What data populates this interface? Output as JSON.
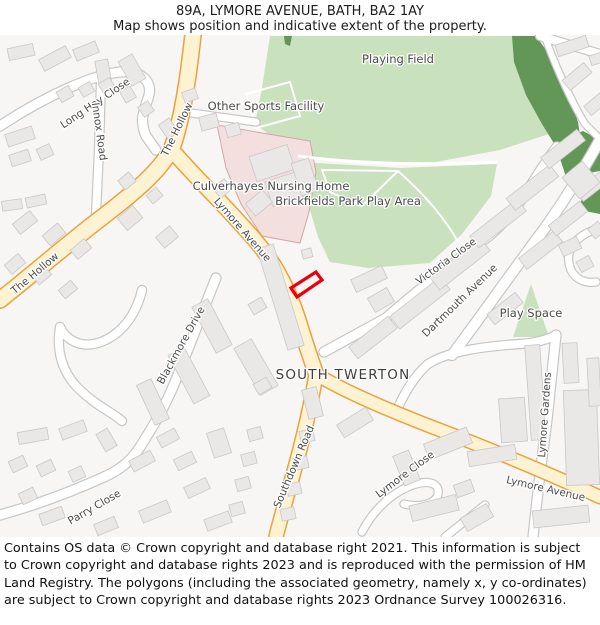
{
  "header": {
    "title": "89A, LYMORE AVENUE, BATH, BA2 1AY",
    "subtitle": "Map shows position and indicative extent of the property."
  },
  "footer": {
    "text": "Contains OS data © Crown copyright and database right 2021. This information is subject to Crown copyright and database rights 2023 and is reproduced with the permission of HM Land Registry. The polygons (including the associated geometry, namely x, y co-ordinates) are subject to Crown copyright and database rights 2023 Ordnance Survey 100026316."
  },
  "map": {
    "background": "#f7f6f4",
    "palette": {
      "lightGreen": "#c9e1bc",
      "darkGreen": "#629757",
      "pinkFill": "#f4dfdf",
      "pinkStroke": "#d3a6a4",
      "buildingFill": "#e9e8e6",
      "buildingStroke": "#c9c8c6",
      "roadFill": "#ffffff",
      "roadCasing": "#c6c6c6",
      "primaryFill": "#fdf3d3",
      "primaryCasing": "#eca13b"
    },
    "areas": [
      {
        "name": "playing-field-green",
        "points": "270,36 512,36 530,64 545,100 552,133 500,150 430,163 365,161 298,156 255,124 262,88",
        "fill": "lightGreen"
      },
      {
        "name": "brickfields-green",
        "points": "300,162 400,168 497,164 491,196 462,234 430,263 368,268 330,262 318,237 306,196",
        "fill": "lightGreen"
      },
      {
        "name": "tree-strip",
        "points": "512,36 536,36 556,64 569,92 578,122 580,135 558,150 542,124 526,95 514,62",
        "fill": "darkGreen"
      },
      {
        "name": "tree-wedge",
        "points": "555,143 583,131 600,140 600,171 566,177",
        "fill": "darkGreen"
      },
      {
        "name": "tree-patch",
        "points": "584,181 600,177 600,214 580,210",
        "fill": "darkGreen"
      },
      {
        "name": "tree-sliver",
        "points": "284,36 292,36 290,46 285,44",
        "fill": "darkGreen"
      },
      {
        "name": "nursing-home-grounds",
        "points": "217,125 262,133 310,141 316,172 309,212 300,243 262,236 241,204 226,168",
        "fill": "pinkFill",
        "stroke": "pinkStroke"
      },
      {
        "name": "play-space-green",
        "points": "531,284 549,337 513,337",
        "fill": "lightGreen"
      }
    ],
    "roads": [
      {
        "name": "long-hay-close-road",
        "kind": "minor",
        "width": 9,
        "d": "M 0,126 C 45,96 95,74 120,72 C 142,70 152,82 149,95 C 146,107 138,118 146,136 L 156,150"
      },
      {
        "name": "innox-road-road",
        "kind": "minor",
        "width": 8,
        "d": "M 101,80 L 99,150 L 96,214"
      },
      {
        "name": "sports-access-road",
        "kind": "minor",
        "width": 7,
        "d": "M 184,112 L 256,122"
      },
      {
        "name": "blackmore-drive-road",
        "kind": "minor",
        "width": 9,
        "d": "M 216,278 C 205,305 190,345 175,382 C 165,407 152,428 140,447"
      },
      {
        "name": "leftmid-road-a",
        "kind": "minor",
        "width": 8,
        "d": "M 142,290 C 136,316 120,336 98,343 C 80,348 66,340 60,327"
      },
      {
        "name": "leftmid-road-b",
        "kind": "minor",
        "width": 8,
        "d": "M 60,327 C 56,350 62,372 78,388 C 96,406 112,412 122,421"
      },
      {
        "name": "parry-close-road",
        "kind": "minor",
        "width": 9,
        "d": "M 140,447 C 132,460 120,470 104,477 C 75,490 40,504 0,515"
      },
      {
        "name": "victoria-close-road",
        "kind": "minor",
        "width": 9,
        "d": "M 324,352 L 386,318 C 420,288 455,262 490,235 C 505,222 518,205 528,190 C 537,176 546,161 557,147"
      },
      {
        "name": "dartmouth-avenue-road",
        "kind": "minor",
        "width": 10,
        "d": "M 452,355 C 480,318 512,272 545,228 C 565,200 582,172 600,140"
      },
      {
        "name": "cross-road-south",
        "kind": "minor",
        "width": 8,
        "d": "M 396,412 C 402,398 412,378 428,364 C 450,350 490,346 520,344 C 536,343 549,339 556,335"
      },
      {
        "name": "lymore-gardens-road",
        "kind": "minor",
        "width": 9,
        "d": "M 556,335 L 547,420 L 539,482 L 533,537"
      },
      {
        "name": "cul-de-sac-road",
        "kind": "minor",
        "width": 7,
        "d": "M 600,228 C 578,234 566,248 569,263 C 571,277 583,284 596,282"
      },
      {
        "name": "lymore-close-road",
        "kind": "minor",
        "width": 7,
        "d": "M 362,532 C 372,512 390,494 410,486 C 428,479 440,483 438,494 C 436,504 420,508 404,504"
      },
      {
        "name": "topright-road-a",
        "kind": "minor",
        "width": 8,
        "d": "M 540,36 L 600,54"
      },
      {
        "name": "topright-road-b",
        "kind": "minor",
        "width": 6,
        "d": "M 546,40 C 558,72 572,102 585,124 L 600,139"
      },
      {
        "name": "bottomright-corner-road",
        "kind": "minor",
        "width": 7,
        "d": "M 445,537 L 485,505"
      },
      {
        "name": "the-hollow-road",
        "kind": "primary",
        "width": 15,
        "d": "M 193,35 C 188,80 182,120 172,148 C 160,172 130,196 96,222 C 70,242 35,272 0,300"
      },
      {
        "name": "lymore-avenue-road",
        "kind": "primary",
        "width": 14,
        "d": "M 172,150 C 190,172 225,205 255,240 C 275,263 290,292 300,325 C 306,345 312,362 316,374"
      },
      {
        "name": "southdown-road-road",
        "kind": "primary",
        "width": 13,
        "d": "M 316,374 C 312,400 303,440 293,475 C 286,500 280,520 276,537"
      },
      {
        "name": "lymore-avenue-east-road",
        "kind": "primary",
        "width": 12,
        "d": "M 316,374 C 345,392 395,413 445,432 C 495,451 545,472 600,497"
      }
    ],
    "paths": [
      {
        "name": "sports-pitch-outline",
        "width": 2,
        "d": "M 246,94 L 290,82 L 300,116 L 256,128 Z"
      },
      {
        "name": "park-path-separator",
        "width": 3,
        "d": "M 298,156 C 350,163 420,166 497,162"
      },
      {
        "name": "park-path-loop",
        "width": 2,
        "d": "M 322,170 L 398,171 L 362,206 L 330,192 Z"
      },
      {
        "name": "park-path-southeast",
        "width": 2,
        "d": "M 398,171 C 425,195 445,218 458,242"
      }
    ],
    "buildings": [
      [
        8,
        46,
        26,
        12,
        -12
      ],
      [
        40,
        52,
        30,
        13,
        -28
      ],
      [
        74,
        45,
        24,
        12,
        -22
      ],
      [
        97,
        60,
        13,
        26,
        -10
      ],
      [
        124,
        56,
        16,
        28,
        -30
      ],
      [
        58,
        88,
        14,
        12,
        -30
      ],
      [
        80,
        84,
        13,
        11,
        -30
      ],
      [
        100,
        80,
        13,
        11,
        -30
      ],
      [
        122,
        88,
        12,
        13,
        -30
      ],
      [
        140,
        103,
        12,
        12,
        -35
      ],
      [
        6,
        130,
        28,
        13,
        -18
      ],
      [
        10,
        152,
        20,
        12,
        -18
      ],
      [
        38,
        146,
        14,
        12,
        -25
      ],
      [
        2,
        200,
        20,
        10,
        -8
      ],
      [
        26,
        196,
        20,
        10,
        -12
      ],
      [
        14,
        216,
        22,
        13,
        -38
      ],
      [
        44,
        228,
        20,
        13,
        -40
      ],
      [
        72,
        243,
        18,
        12,
        -40
      ],
      [
        6,
        258,
        18,
        12,
        -40
      ],
      [
        34,
        270,
        16,
        11,
        -40
      ],
      [
        60,
        284,
        16,
        11,
        -40
      ],
      [
        120,
        175,
        14,
        12,
        -40
      ],
      [
        148,
        190,
        13,
        11,
        -40
      ],
      [
        120,
        210,
        20,
        16,
        -40
      ],
      [
        158,
        230,
        18,
        14,
        -40
      ],
      [
        200,
        115,
        18,
        14,
        -15
      ],
      [
        226,
        124,
        14,
        12,
        -15
      ],
      [
        162,
        120,
        13,
        17,
        -35
      ],
      [
        183,
        90,
        14,
        11,
        -20
      ],
      [
        252,
        150,
        40,
        26,
        -18
      ],
      [
        268,
        176,
        34,
        26,
        -18
      ],
      [
        296,
        160,
        18,
        34,
        -18
      ],
      [
        248,
        195,
        22,
        16,
        -40
      ],
      [
        215,
        182,
        15,
        13,
        -40
      ],
      [
        272,
        244,
        17,
        106,
        -17
      ],
      [
        302,
        249,
        10,
        9,
        -15
      ],
      [
        352,
        272,
        34,
        14,
        -25
      ],
      [
        370,
        292,
        22,
        16,
        -30
      ],
      [
        203,
        300,
        18,
        52,
        -28
      ],
      [
        246,
        340,
        20,
        54,
        -30
      ],
      [
        180,
        348,
        18,
        55,
        -28
      ],
      [
        145,
        380,
        16,
        44,
        -25
      ],
      [
        250,
        300,
        15,
        12,
        -30
      ],
      [
        255,
        380,
        15,
        12,
        -30
      ],
      [
        305,
        388,
        15,
        30,
        -14
      ],
      [
        300,
        430,
        14,
        12,
        -12
      ],
      [
        294,
        457,
        14,
        12,
        -12
      ],
      [
        287,
        483,
        14,
        12,
        -12
      ],
      [
        281,
        508,
        14,
        12,
        -12
      ],
      [
        248,
        428,
        14,
        12,
        -15
      ],
      [
        242,
        453,
        14,
        12,
        -15
      ],
      [
        236,
        478,
        14,
        12,
        -15
      ],
      [
        230,
        503,
        14,
        12,
        -15
      ],
      [
        210,
        430,
        18,
        26,
        -18
      ],
      [
        18,
        430,
        30,
        12,
        -10
      ],
      [
        60,
        424,
        26,
        12,
        -20
      ],
      [
        100,
        430,
        13,
        20,
        -30
      ],
      [
        10,
        458,
        16,
        12,
        -25
      ],
      [
        38,
        462,
        16,
        12,
        -25
      ],
      [
        70,
        468,
        14,
        12,
        -25
      ],
      [
        20,
        490,
        16,
        12,
        -25
      ],
      [
        130,
        455,
        24,
        12,
        -28
      ],
      [
        158,
        432,
        20,
        12,
        -28
      ],
      [
        175,
        455,
        20,
        12,
        -26
      ],
      [
        40,
        510,
        24,
        12,
        -20
      ],
      [
        140,
        505,
        30,
        13,
        -22
      ],
      [
        185,
        482,
        24,
        12,
        -25
      ],
      [
        205,
        515,
        26,
        12,
        -20
      ],
      [
        95,
        520,
        22,
        12,
        -22
      ],
      [
        348,
        330,
        50,
        15,
        -38
      ],
      [
        388,
        295,
        64,
        16,
        -38
      ],
      [
        428,
        256,
        64,
        16,
        -38
      ],
      [
        468,
        216,
        60,
        15,
        -38
      ],
      [
        505,
        180,
        55,
        15,
        -38
      ],
      [
        540,
        142,
        46,
        14,
        -38
      ],
      [
        518,
        243,
        45,
        14,
        -38
      ],
      [
        548,
        212,
        40,
        13,
        -38
      ],
      [
        576,
        180,
        32,
        13,
        -38
      ],
      [
        487,
        302,
        36,
        13,
        -38
      ],
      [
        556,
        40,
        32,
        12,
        -18
      ],
      [
        590,
        54,
        12,
        10,
        -18
      ],
      [
        563,
        70,
        28,
        13,
        -40
      ],
      [
        585,
        98,
        22,
        12,
        -40
      ],
      [
        568,
        166,
        26,
        28,
        -40
      ],
      [
        560,
        240,
        20,
        13,
        -25
      ],
      [
        578,
        258,
        14,
        12,
        -28
      ],
      [
        590,
        224,
        13,
        12,
        -40
      ],
      [
        338,
        415,
        34,
        15,
        -32
      ],
      [
        425,
        435,
        46,
        17,
        -22
      ],
      [
        398,
        452,
        17,
        32,
        -22
      ],
      [
        410,
        500,
        48,
        16,
        -14
      ],
      [
        455,
        482,
        18,
        13,
        -20
      ],
      [
        468,
        448,
        48,
        15,
        -9
      ],
      [
        528,
        345,
        15,
        95,
        -4
      ],
      [
        563,
        343,
        15,
        40,
        -3
      ],
      [
        565,
        390,
        33,
        95,
        -2
      ],
      [
        588,
        358,
        12,
        48,
        -3
      ],
      [
        533,
        508,
        56,
        17,
        -6
      ],
      [
        462,
        510,
        30,
        15,
        -30
      ],
      [
        500,
        398,
        26,
        44,
        -4
      ]
    ],
    "plot": {
      "name": "property-boundary",
      "points": "291,288 316,272 322,280 297,297",
      "color": "#e8000d"
    },
    "labels": [
      {
        "name": "label-playing-field",
        "text": "Playing Field",
        "x": 398,
        "y": 63,
        "rot": 0,
        "cls": "area"
      },
      {
        "name": "label-other-sports-facility",
        "text": "Other Sports Facility",
        "x": 266,
        "y": 110,
        "rot": 0,
        "cls": "area"
      },
      {
        "name": "label-culverhayes-nursing-home",
        "text": "Culverhayes Nursing Home",
        "x": 271,
        "y": 190,
        "rot": 0,
        "cls": "area"
      },
      {
        "name": "label-brickfields-park-play-area",
        "text": "Brickfields Park Play Area",
        "x": 348,
        "y": 205,
        "rot": 0,
        "cls": "area"
      },
      {
        "name": "label-south-twerton",
        "text": "SOUTH TWERTON",
        "x": 343,
        "y": 379,
        "rot": 0,
        "cls": "place"
      },
      {
        "name": "label-play-space",
        "text": "Play Space",
        "x": 531,
        "y": 317,
        "rot": 0,
        "cls": "area"
      },
      {
        "name": "label-the-hollow-top",
        "text": "The Hollow",
        "x": 180,
        "y": 131,
        "rot": -64,
        "cls": "road"
      },
      {
        "name": "label-the-hollow-left",
        "text": "The Hollow",
        "x": 37,
        "y": 276,
        "rot": -40,
        "cls": "road"
      },
      {
        "name": "label-long-hay-close",
        "text": "Long Hay Close",
        "x": 97,
        "y": 106,
        "rot": -34,
        "cls": "road"
      },
      {
        "name": "label-innox-road",
        "text": "Innox Road",
        "x": 96,
        "y": 132,
        "rot": 82,
        "cls": "road"
      },
      {
        "name": "label-lymore-avenue",
        "text": "Lymore Avenue",
        "x": 240,
        "y": 232,
        "rot": 49,
        "cls": "road"
      },
      {
        "name": "label-blackmore-drive",
        "text": "Blackmore Drive",
        "x": 184,
        "y": 347,
        "rot": -61,
        "cls": "road"
      },
      {
        "name": "label-victoria-close",
        "text": "Victoria Close",
        "x": 448,
        "y": 264,
        "rot": -36,
        "cls": "road"
      },
      {
        "name": "label-dartmouth-avenue",
        "text": "Dartmouth Avenue",
        "x": 462,
        "y": 303,
        "rot": -44,
        "cls": "road"
      },
      {
        "name": "label-southdown-road",
        "text": "Southdown Road",
        "x": 297,
        "y": 468,
        "rot": -67,
        "cls": "road"
      },
      {
        "name": "label-lymore-close",
        "text": "Lymore Close",
        "x": 407,
        "y": 477,
        "rot": -37,
        "cls": "road"
      },
      {
        "name": "label-lymore-gardens",
        "text": "Lymore Gardens",
        "x": 548,
        "y": 415,
        "rot": -86,
        "cls": "road"
      },
      {
        "name": "label-lymore-avenue-bottom",
        "text": "Lymore Avenue",
        "x": 545,
        "y": 492,
        "rot": 13,
        "cls": "road"
      },
      {
        "name": "label-parry-close",
        "text": "Parry Close",
        "x": 96,
        "y": 510,
        "rot": -30,
        "cls": "road"
      }
    ]
  }
}
